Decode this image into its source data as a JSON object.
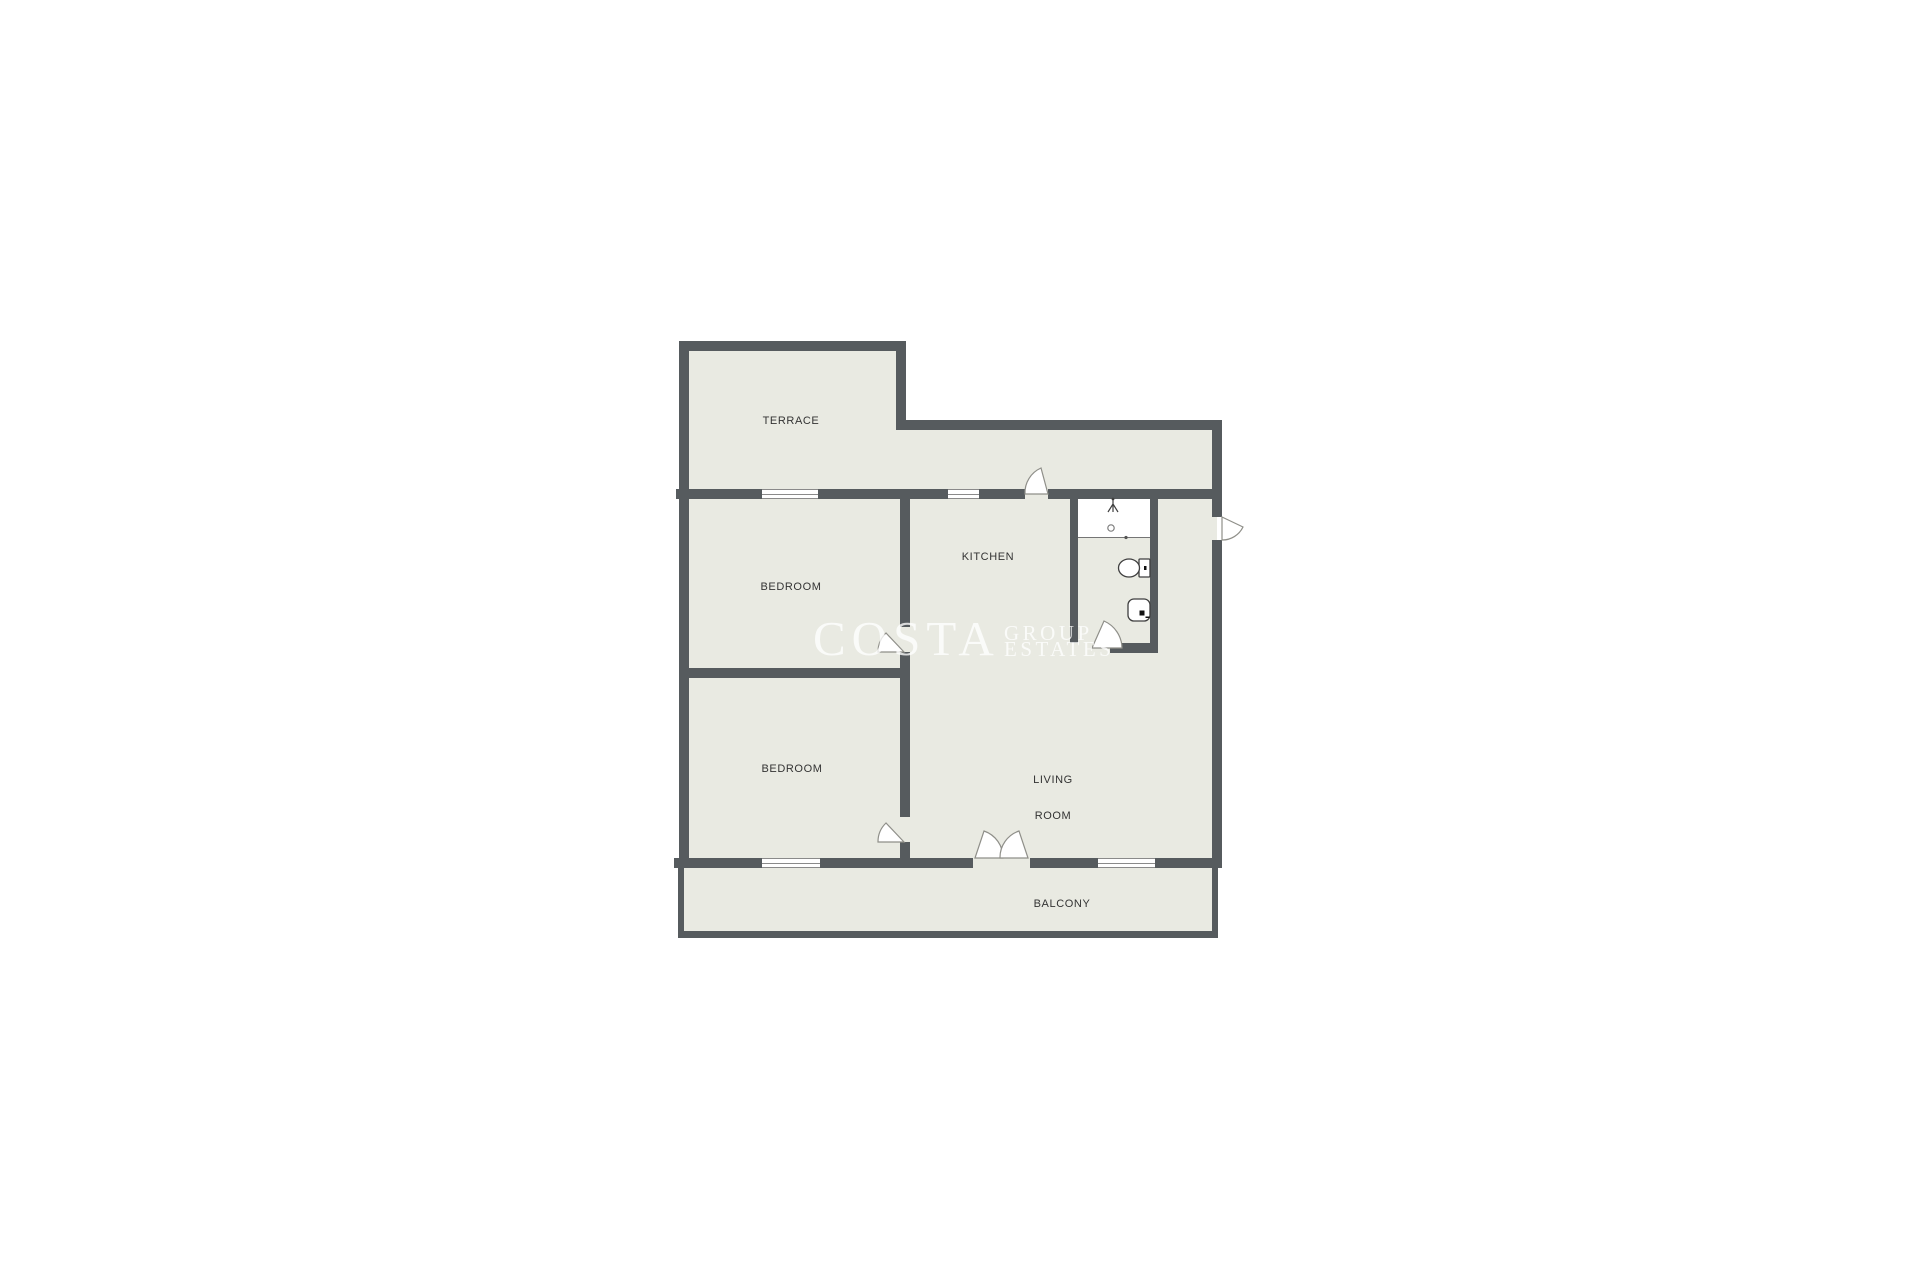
{
  "colors": {
    "background": "#ffffff",
    "floor": "#e9eae2",
    "wall": "#565b5e",
    "window_fill": "#ffffff",
    "window_line": "#8a8a8a",
    "door_stroke": "#8f8f89",
    "door_fill": "#ffffff",
    "fixture_stroke": "#3f3f3f",
    "label_text": "#333333",
    "watermark": "rgba(255,255,255,0.78)"
  },
  "rooms": {
    "terrace": {
      "label": "TERRACE"
    },
    "bedroom_top": {
      "label": "BEDROOM"
    },
    "bedroom_bottom": {
      "label": "BEDROOM"
    },
    "kitchen": {
      "label": "KITCHEN"
    },
    "living_room": {
      "label_line1": "LIVING",
      "label_line2": "ROOM"
    },
    "balcony": {
      "label": "BALCONY"
    }
  },
  "watermark": {
    "line1": "COSTA",
    "line2": "GROUP",
    "line3": "ESTATES"
  },
  "fixtures": {
    "shower": "shower-head-icon",
    "toilet": "toilet-icon",
    "sink": "sink-icon"
  }
}
